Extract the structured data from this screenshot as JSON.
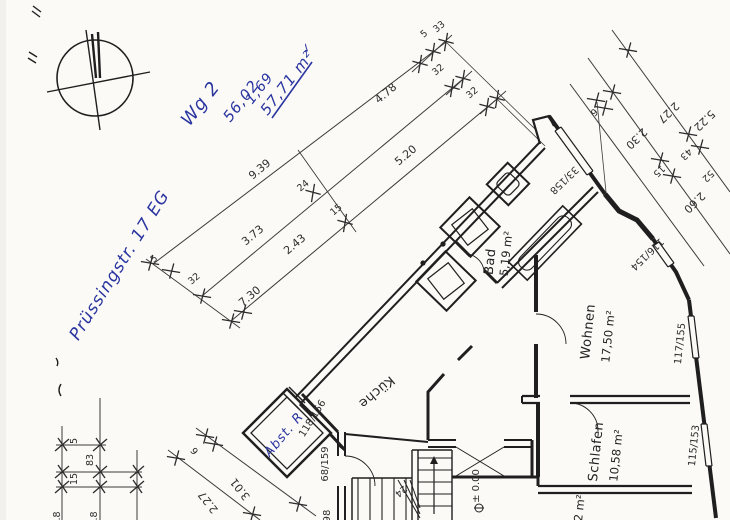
{
  "document": {
    "kind": "Scanned architectural floor plan sketch (ground floor, apartment Wg 2)",
    "paper_color": "#fbfaf7",
    "ink_color": "#1f1f1f",
    "pen_color": "#2a35a0"
  },
  "handwritten_notes": {
    "unit": "Wg 2",
    "calc_top": "56,02",
    "calc_add": "1,69",
    "calc_total": "57,71 m²",
    "check_mark": "✓",
    "address": "Prüssingstr. 17 EG",
    "storage_room": "Abst. R"
  },
  "rooms": {
    "bad": {
      "name": "Bad",
      "area": "5,19 m²"
    },
    "wohnen": {
      "name": "Wohnen",
      "area": "17,50 m²"
    },
    "schlafen": {
      "name": "Schlafen",
      "area": "10,58 m²"
    },
    "kueche": {
      "name": "Küche"
    },
    "cut_room": {
      "area": "12 m²"
    }
  },
  "marks": {
    "level": "± 0.00",
    "stair_count": "24"
  },
  "openings": {
    "window_top": "33/158",
    "window_bay": "116/154",
    "window_living": "117/155",
    "window_bedroom": "115/153",
    "door_balcony": "118/156",
    "door_stair": "68/159",
    "door_partial": "98"
  },
  "dimensions": {
    "main_chain": {
      "seg_a": "9.39",
      "seg_b": "4.78",
      "seg_c": "3.73",
      "seg_d": "2.43",
      "seg_e": "5.20",
      "seg_f": "7.30",
      "off_a": "24",
      "off_b": "15",
      "end_left_a": "5",
      "end_left_b": "32",
      "end_right_a": "5",
      "end_right_b": "33",
      "end_right_c": "32",
      "end_right_d": "32"
    },
    "right_chain": {
      "seg_a": "5.22",
      "seg_b": "2.27",
      "seg_c": "2.30",
      "seg_d": "6",
      "seg_e": "43",
      "seg_f": "15",
      "seg_g": "52",
      "seg_h": "2.60"
    },
    "bottom_chain": {
      "seg_a": "5",
      "seg_b": "83",
      "seg_c": "15",
      "seg_d": "1.8",
      "seg_e": "1.8"
    },
    "court_chain": {
      "seg_a": "6",
      "seg_b": "2.27",
      "seg_c": "3.01"
    }
  }
}
